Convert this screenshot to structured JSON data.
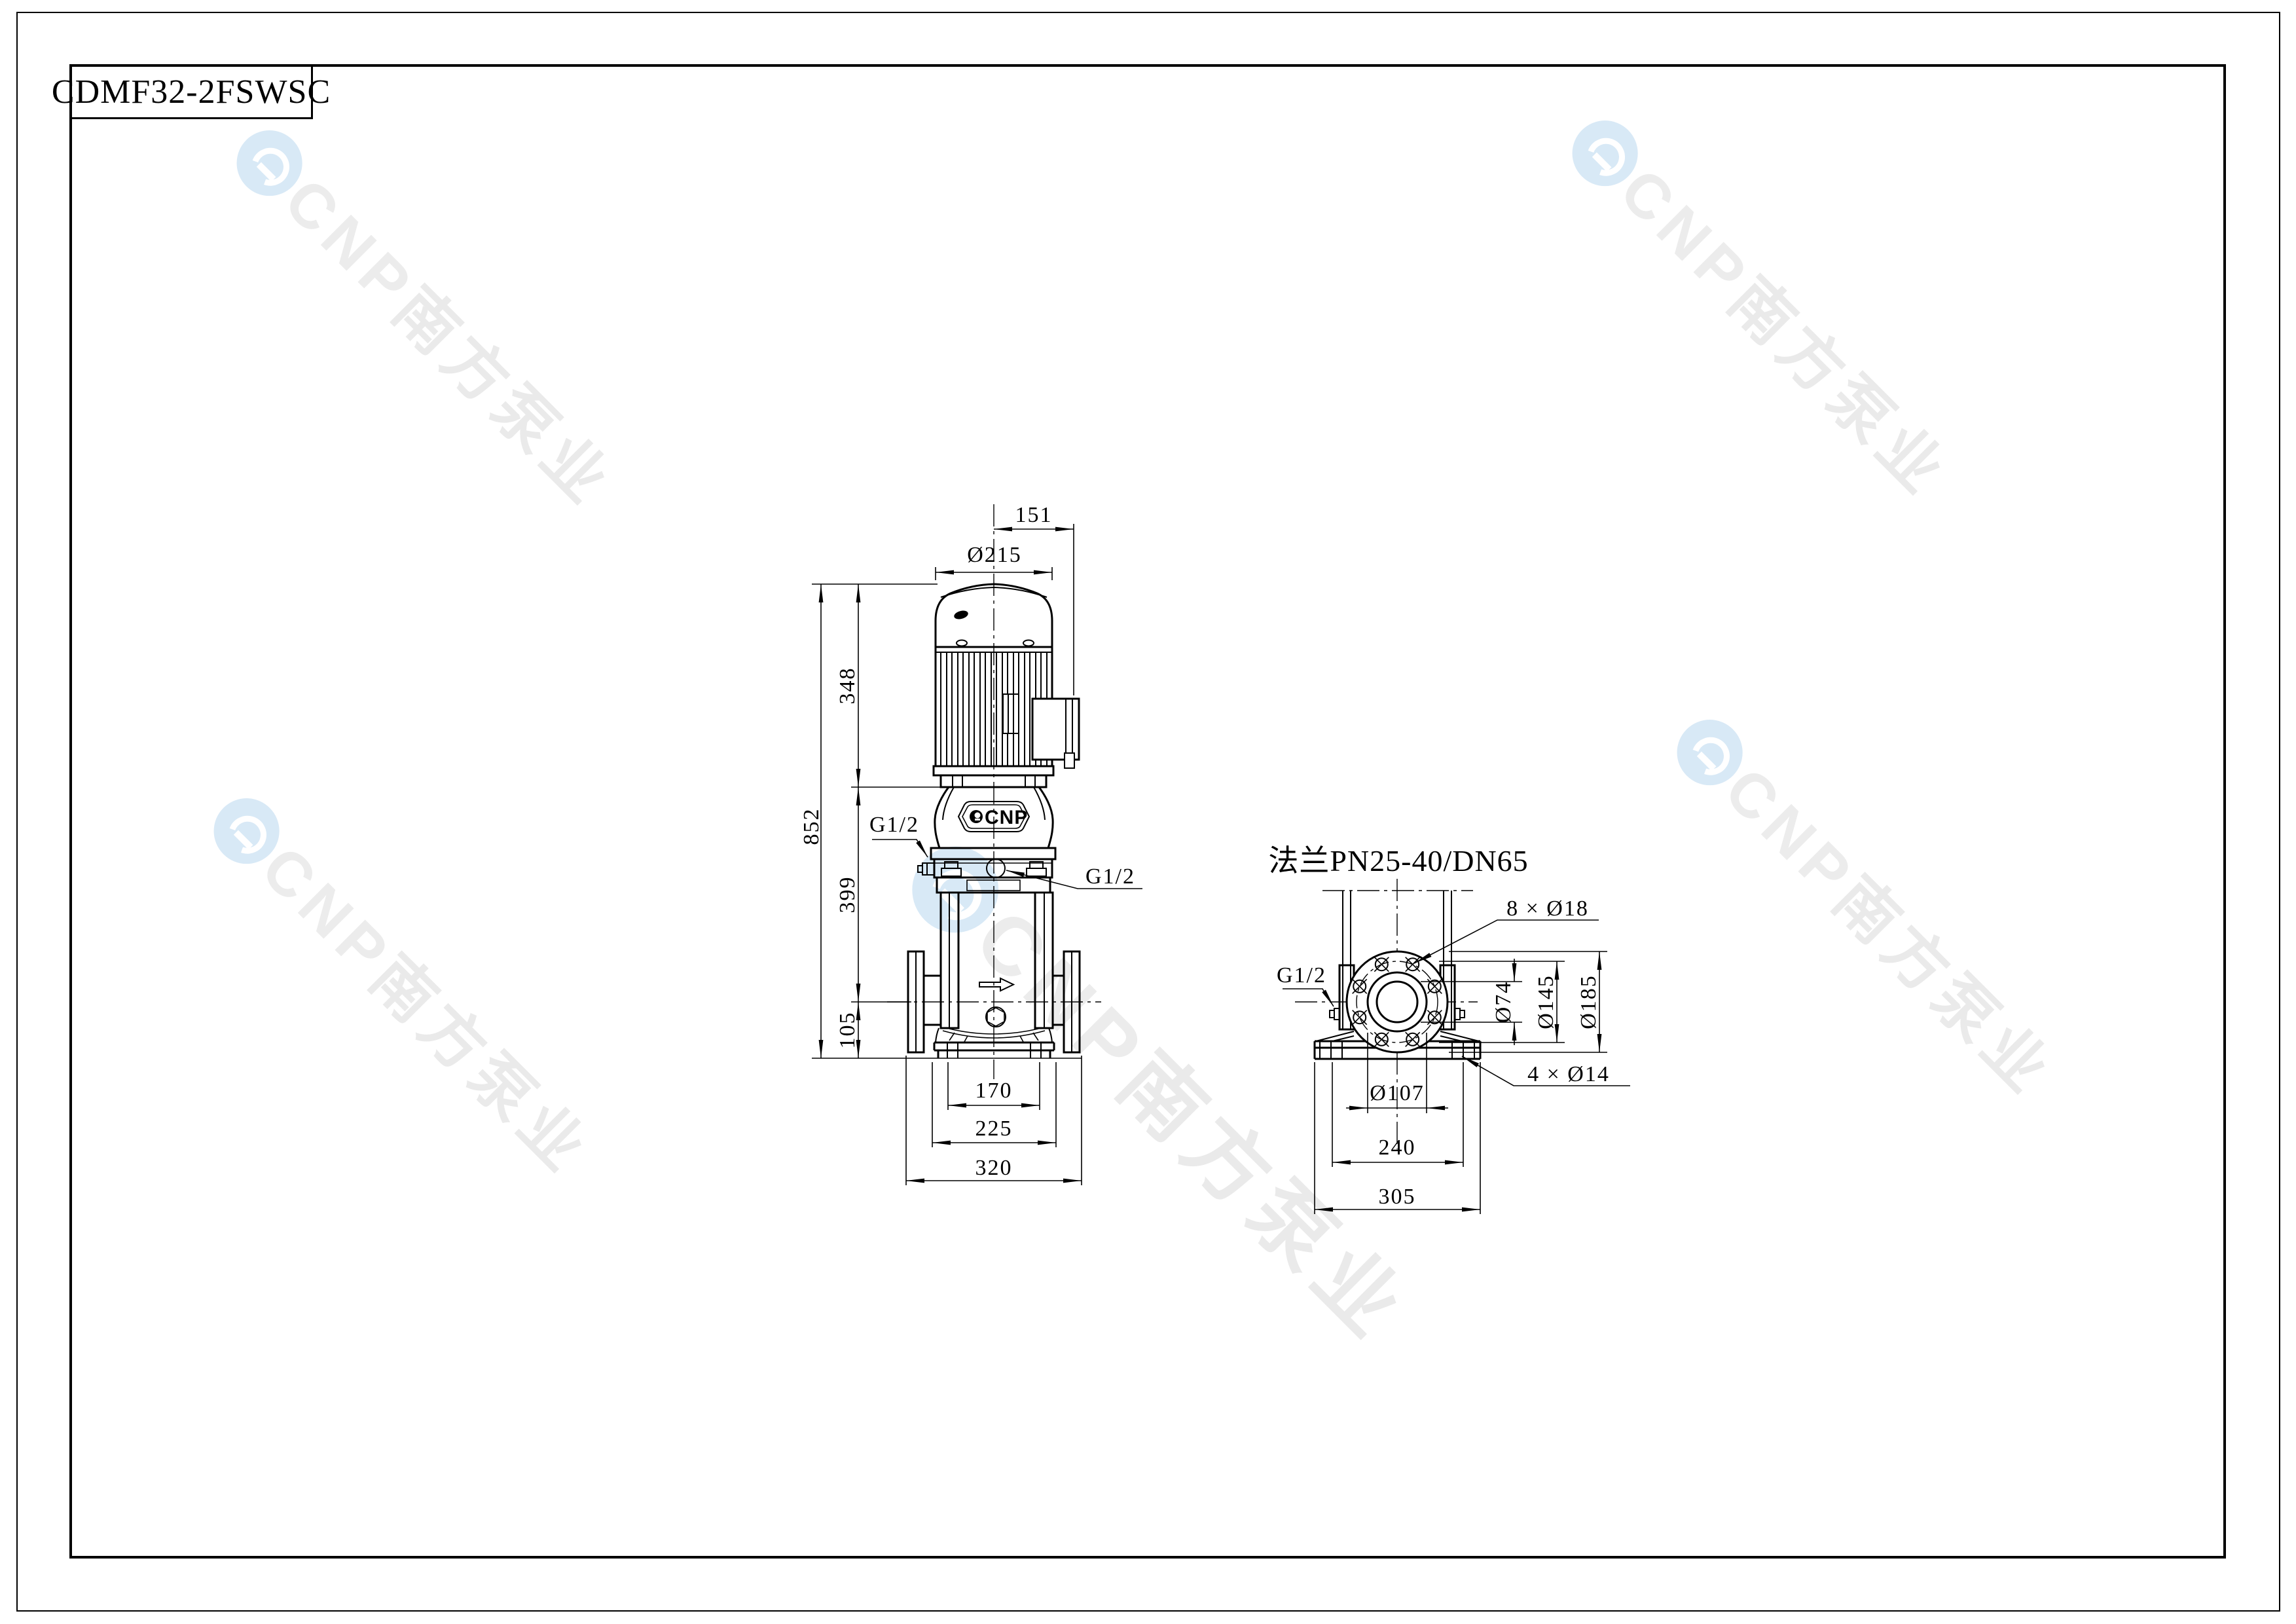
{
  "sheet": {
    "part_number": "CDMF32-2FSWSC"
  },
  "watermark": {
    "latin": "CNP",
    "chinese": "南方泵业"
  },
  "front_view": {
    "pump_logo": "CNP",
    "dims": {
      "top_offset": "151",
      "motor_diameter": "Ø215",
      "motor_height": "348",
      "total_height": "852",
      "pump_section_height": "399",
      "base_height": "105",
      "port_left": "G1/2",
      "port_drain": "G1/2",
      "foot_inner_width": "170",
      "base_width": "225",
      "flange_span": "320"
    }
  },
  "flange_view": {
    "title": "法兰PN25-40/DN65",
    "dims": {
      "bolt_holes": "8 × Ø18",
      "port": "G1/2",
      "bore_diameter": "Ø74",
      "bolt_circle": "Ø145",
      "flange_od": "Ø185",
      "raised_face": "Ø107",
      "anchor_holes": "4 × Ø14",
      "foot_hole_span": "240",
      "baseplate_width": "305"
    }
  }
}
